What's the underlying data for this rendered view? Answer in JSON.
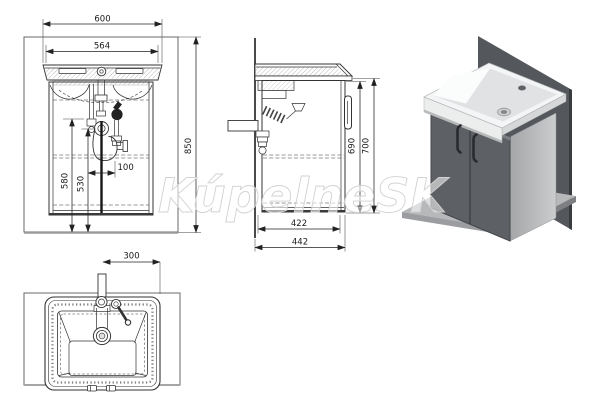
{
  "watermark": {
    "text": "KúpelneSK"
  },
  "dimensions": {
    "front": {
      "overall_width": "600",
      "basin_inner_width": "564",
      "overall_height": "850",
      "drain_height": "580",
      "trap_height": "530",
      "drain_offset": "100"
    },
    "side": {
      "cabinet_height": "690",
      "total_height": "700",
      "cabinet_depth": "422",
      "total_depth": "442"
    },
    "top": {
      "tap_to_edge": "300"
    }
  },
  "colors": {
    "wall_3d": "#54575b",
    "floor_3d": "#b7b8ba",
    "cabinet_3d": "#5d6064",
    "basin_3d": "#f4f5f6",
    "drawing_line": "#333333",
    "dim_text": "#1a1a1a",
    "watermark_stroke": "#d2d2d2"
  }
}
